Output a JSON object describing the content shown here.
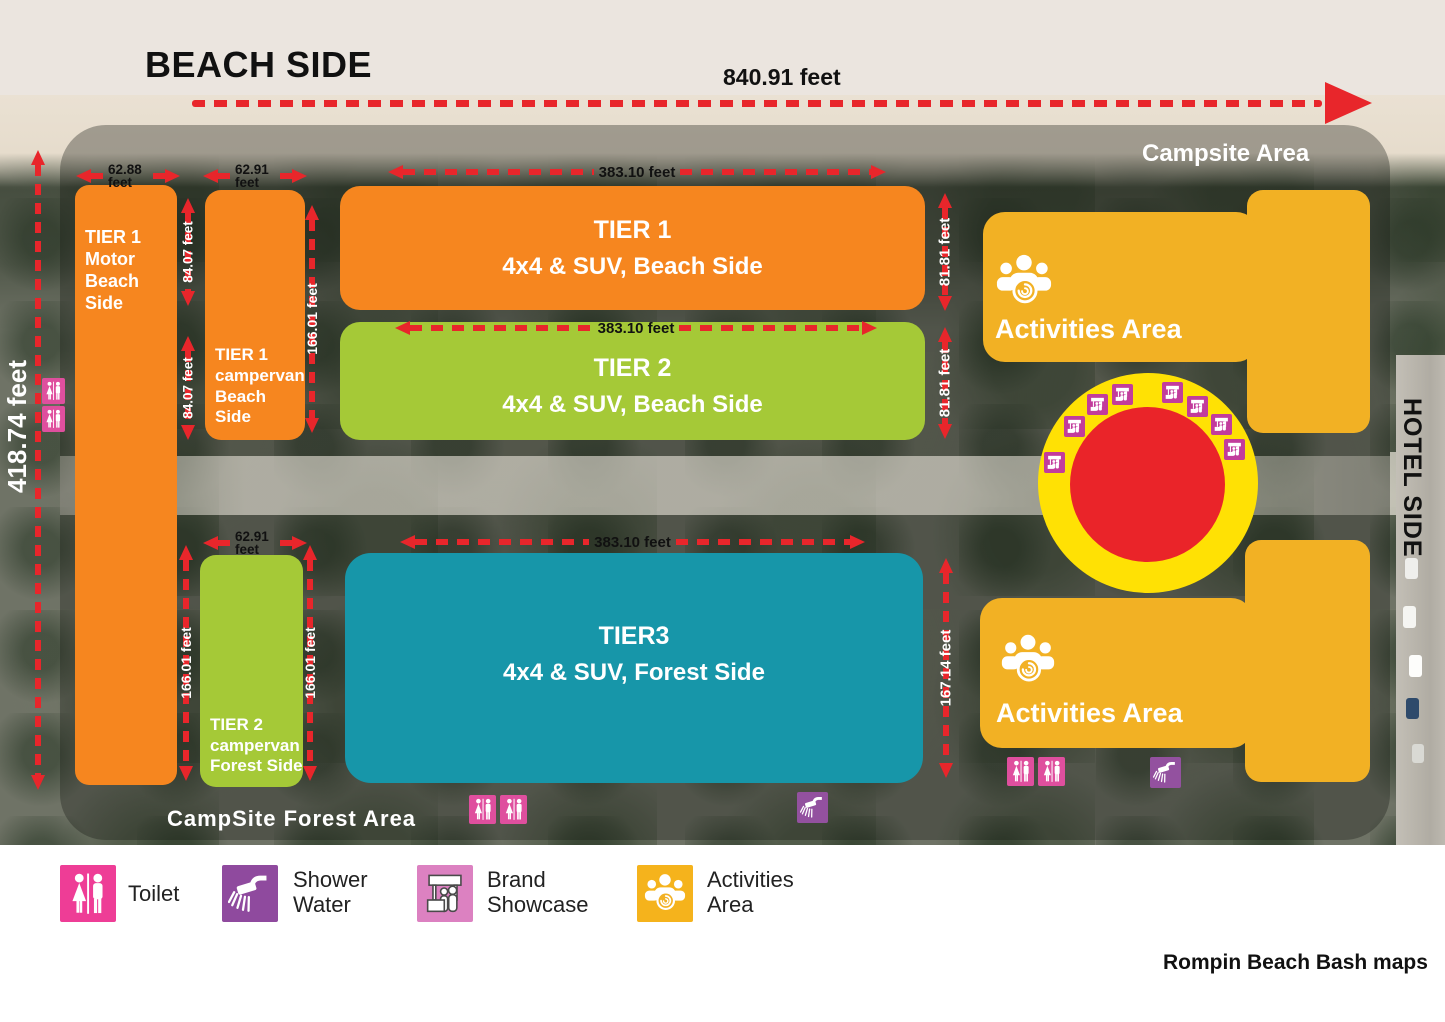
{
  "labels": {
    "beach_side": "BEACH SIDE",
    "hotel_side": "HOTEL SIDE",
    "campsite_area": "Campsite Area",
    "campsite_forest_area": "CampSite Forest Area",
    "credit": "Rompin Beach Bash maps"
  },
  "dimensions": {
    "beach_width": "840.91 feet",
    "site_height": "418.74 feet",
    "tier1_motor_width": "62.88 feet",
    "tier1_campervan_width": "62.91 feet",
    "tier2_campervan_width": "62.91 feet",
    "tier1_row_width": "383.10 feet",
    "tier2_row_width": "383.10 feet",
    "tier3_row_width": "383.10 feet",
    "tier1_row_height": "81.81 feet",
    "tier2_row_height": "81.81 feet",
    "tier3_row_height": "167.14 feet",
    "gap_a": "84.07 feet",
    "gap_b": "84.07 feet",
    "tier1_campervan_height": "166.01 feet",
    "tier2_campervan_height_left": "166.01 feet",
    "tier2_campervan_height_right": "166.01 feet"
  },
  "zones": {
    "tier1_motor": {
      "label": "TIER 1\nMotor\nBeach\nSide"
    },
    "tier1_campervan": {
      "label": "TIER 1\ncampervan\nBeach Side"
    },
    "tier1_row": {
      "title": "TIER 1",
      "subtitle": "4x4 & SUV, Beach Side"
    },
    "tier2_row": {
      "title": "TIER 2",
      "subtitle": "4x4 & SUV, Beach Side"
    },
    "tier3_row": {
      "title": "TIER3",
      "subtitle": "4x4 & SUV, Forest Side"
    },
    "tier2_campervan": {
      "label": "TIER 2\ncampervan\nForest Side"
    },
    "activities_top": {
      "label": "Activities Area"
    },
    "activities_bottom": {
      "label": "Activities Area"
    }
  },
  "legend": {
    "items": [
      {
        "icon": "toilet-icon",
        "label": "Toilet"
      },
      {
        "icon": "shower-icon",
        "label": "Shower\nWater"
      },
      {
        "icon": "brand-showcase-icon",
        "label": "Brand\nShowcase"
      },
      {
        "icon": "activities-icon",
        "label": "Activities\nArea"
      }
    ]
  },
  "colors": {
    "orange": "#F6861F",
    "green": "#A5C937",
    "teal": "#1796A9",
    "amber": "#F2B124",
    "donut_yellow": "#FFE104",
    "red": "#EA2429",
    "toilet_pink": "#DF4F9E",
    "shower_purple": "#93519F",
    "brand_orchid": "#DC81C1",
    "brand_magenta": "#C23C9C"
  }
}
